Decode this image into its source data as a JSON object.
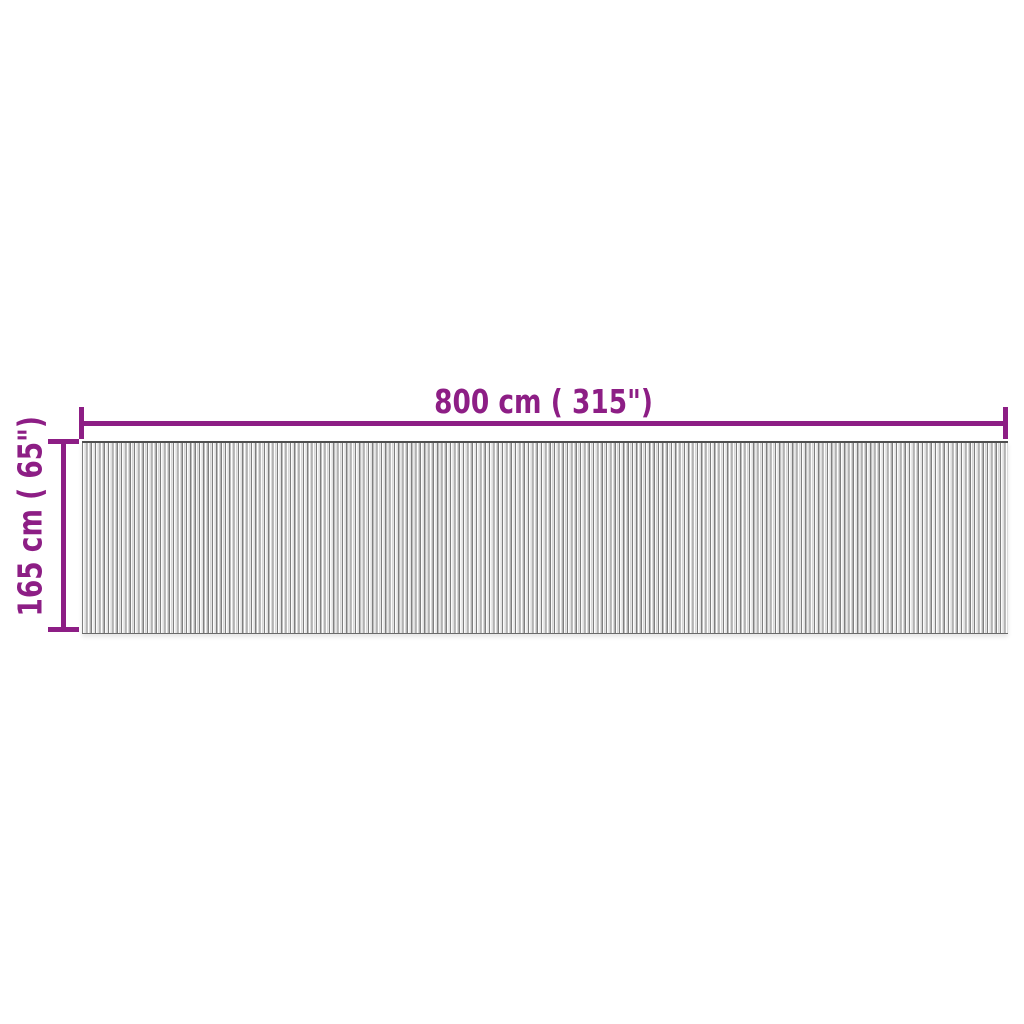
{
  "diagram": {
    "description": "top-view dimension diagram of a long striped roll mat",
    "accent_color": "#8d1e85",
    "width_dimension": {
      "label": "800 cm ( 315\")",
      "value_cm": 800,
      "value_inches": 315
    },
    "height_dimension": {
      "label": "165 cm ( 65\")",
      "value_cm": 165,
      "value_inches": 65
    },
    "mat": {
      "pattern": "fine vertical slats",
      "stripe_dark_color": "#7f7f7f",
      "stripe_light_color": "#ffffff",
      "stripe_mid_color": "#d2d2d2"
    }
  }
}
